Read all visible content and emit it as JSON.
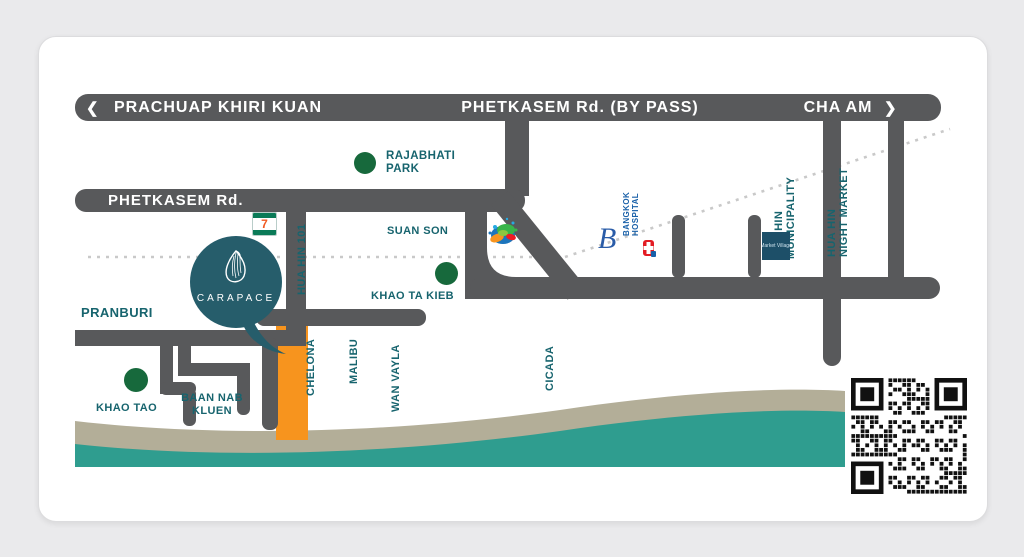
{
  "bypass": {
    "left_arrow": "❮",
    "left": "PRACHUAP KHIRI KUAN",
    "center": "PHETKASEM Rd. (BY PASS)",
    "right": "CHA AM",
    "right_arrow": "❯"
  },
  "roads": {
    "phetkasem": "PHETKASEM Rd.",
    "hua_hin_101": "HUA HIN 101"
  },
  "streets": {
    "chelona": "CHELONA",
    "malibu": "MALIBU",
    "wan_vayla": "WAN VAYLA",
    "cicada": "CICADA"
  },
  "places": {
    "rajabhati_park": "RAJABHATI PARK",
    "suan_son": "SUAN SON",
    "khao_ta_kieb": "KHAO TA KIEB",
    "pranburi": "PRANBURI",
    "khao_tao": "KHAO TAO",
    "baan_nab_kluen": "BAAN NAB KLUEN",
    "municipality_line1": "HUA HIN",
    "municipality_line2": "MUNICIPALITY",
    "night_market_line1": "HUA HIN",
    "night_market_line2": "NIGHT MARKET",
    "hospital_line1": "BANGKOK",
    "hospital_line2": "HOSPITAL",
    "market_village": "Market Village",
    "b_landmark": "B"
  },
  "brand": {
    "name": "CARAPACE",
    "seven_eleven": "7"
  },
  "colors": {
    "road": "#58595b",
    "teal_label": "#17646e",
    "pin": "#265d6b",
    "sea": "#2f9d8f",
    "sand": "#b3ae98",
    "site_orange": "#f7941e",
    "park_green": "#17693c",
    "hospital_blue": "#1960a8",
    "market_village_blue": "#1d4f68",
    "railway_dotted": "#c9c9c9"
  }
}
